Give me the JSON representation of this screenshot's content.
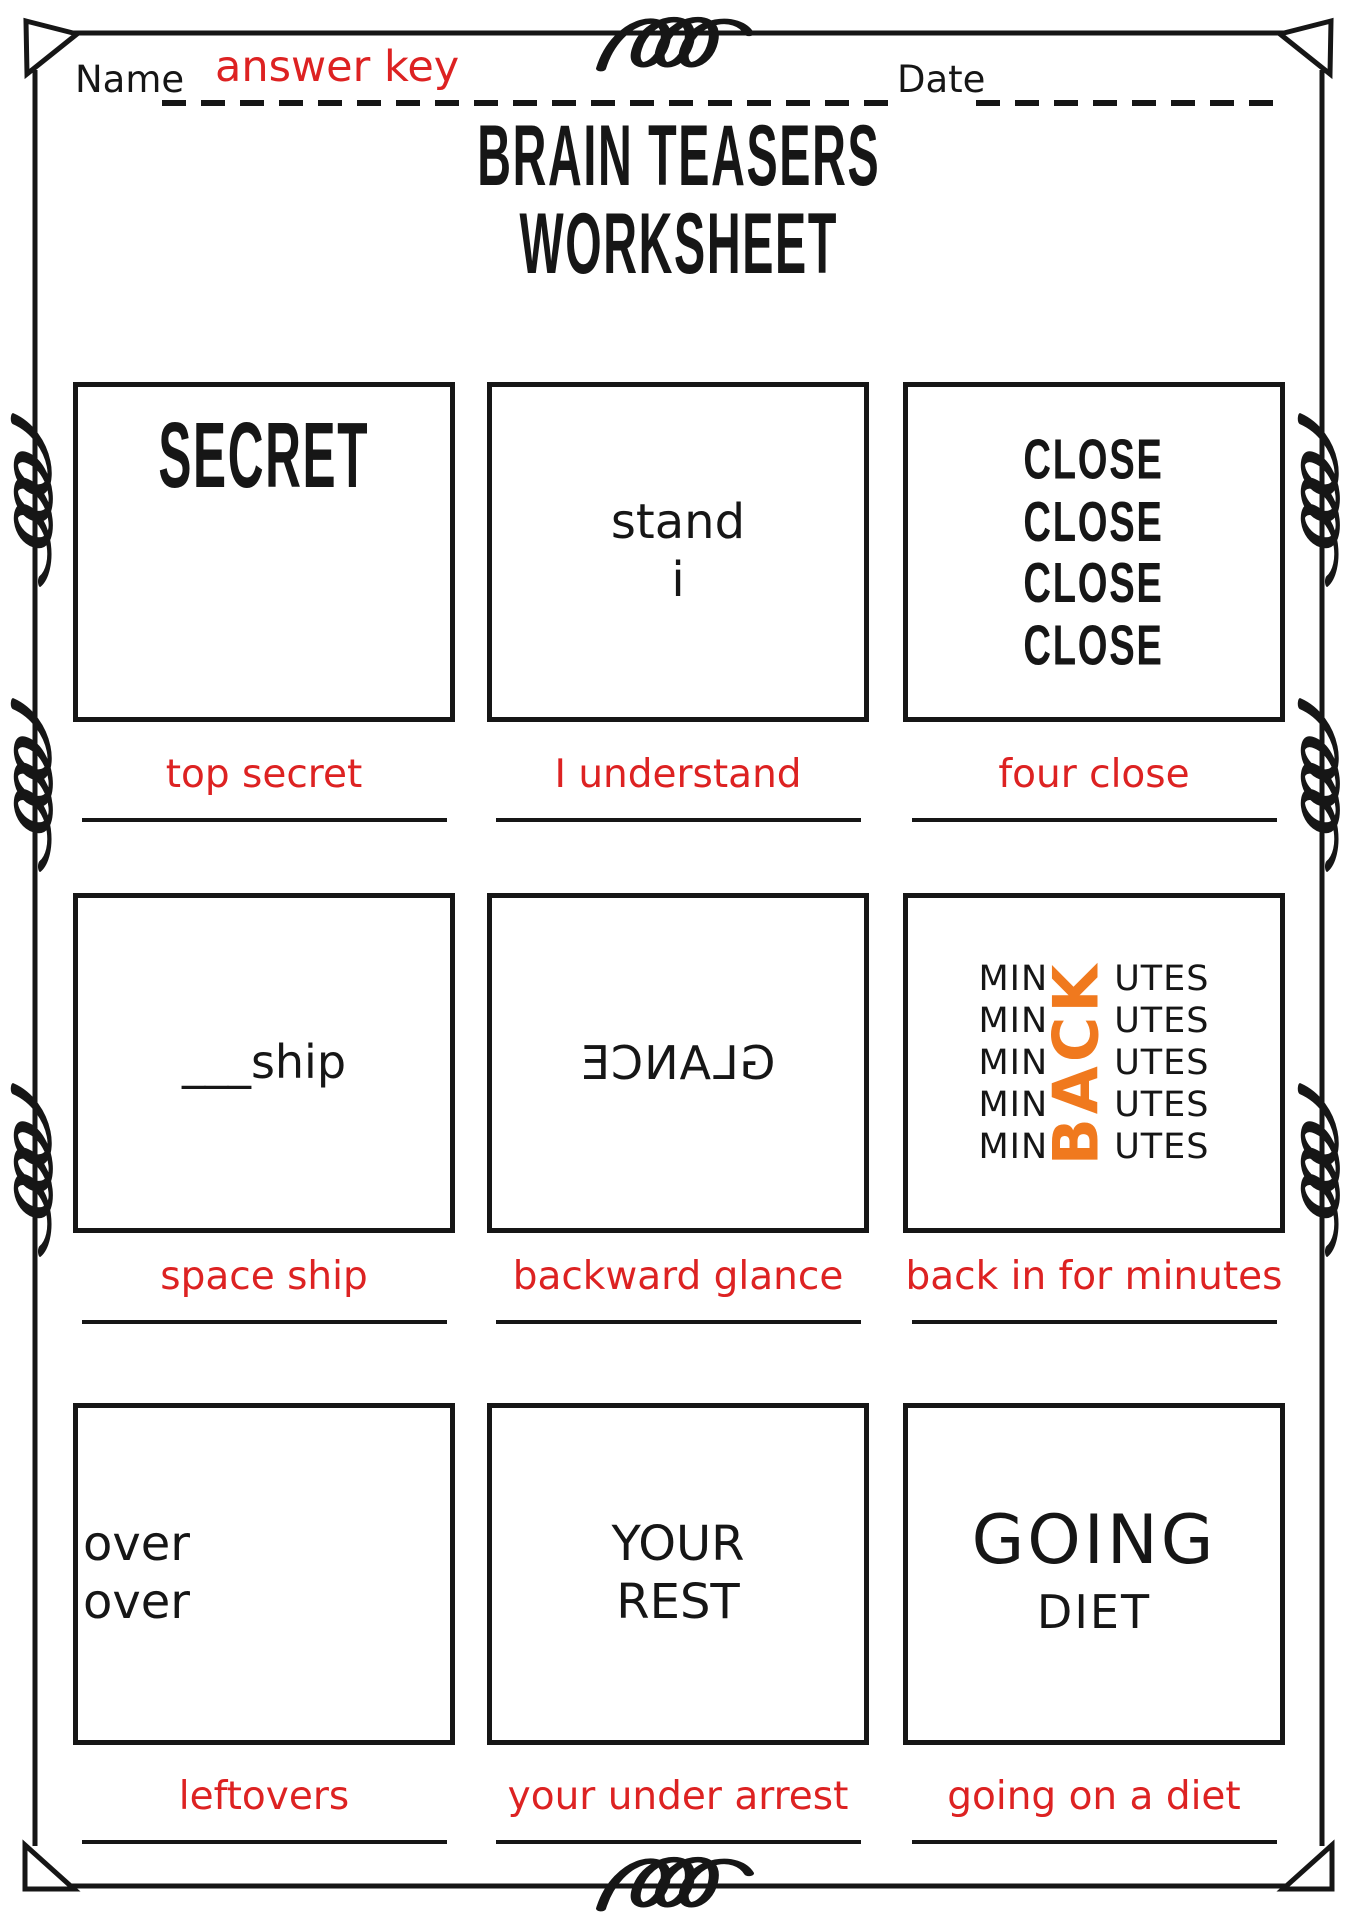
{
  "header": {
    "name_label": "Name",
    "name_value": "answer key",
    "date_label": "Date",
    "date_value": ""
  },
  "title": {
    "line1": "BRAIN TEASERS",
    "line2": "WORKSHEET"
  },
  "colors": {
    "ink": "#161616",
    "answer_red": "#DD2222",
    "accent_orange": "#F0791E"
  },
  "puzzles": [
    {
      "lines": [
        "SECRET"
      ],
      "answer": "top secret"
    },
    {
      "lines": [
        "stand",
        "i"
      ],
      "answer": "I understand"
    },
    {
      "lines": [
        "CLOSE",
        "CLOSE",
        "CLOSE",
        "CLOSE"
      ],
      "answer": "four close"
    },
    {
      "lines": [
        "___ship"
      ],
      "answer": "space ship"
    },
    {
      "mirrored_word": "GLANCE",
      "answer": "backward glance"
    },
    {
      "left": "MIN",
      "right": "UTES",
      "rows": 5,
      "vertical_word": "BACK",
      "vertical_color": "#F0791E",
      "answer": "back in for minutes"
    },
    {
      "lines": [
        "over",
        "over"
      ],
      "answer": "leftovers"
    },
    {
      "lines": [
        "YOUR",
        "REST"
      ],
      "answer": "your under arrest"
    },
    {
      "lines": [
        "GOING",
        "DIET"
      ],
      "answer": "going on a diet"
    }
  ]
}
